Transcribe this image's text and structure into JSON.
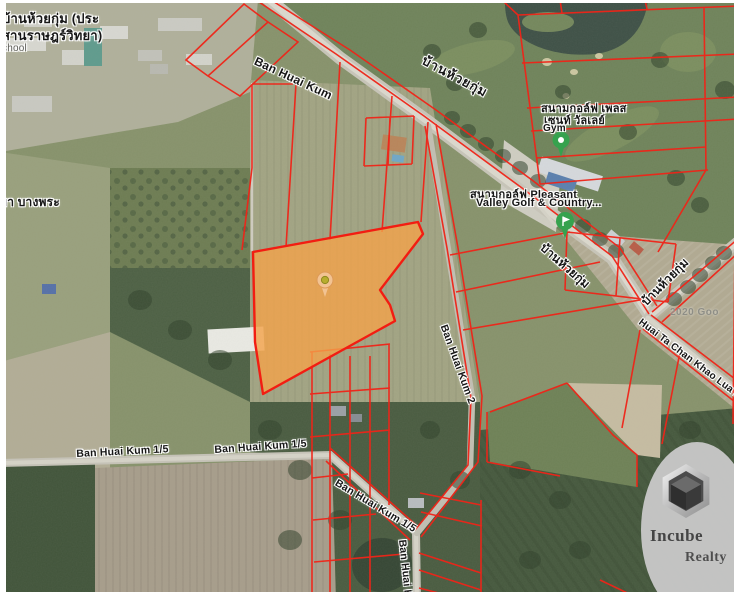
{
  "window": {
    "width": 739,
    "height": 600,
    "view": "satellite-map-with-parcel-overlay"
  },
  "map": {
    "attribution": "2020 Goo",
    "place_labels": {
      "school_line1": "บ้านห้วยกุ่ม (ประ",
      "school_line2": "สานราษฎร์วิทยา)",
      "school_line3": "chool",
      "village_left": "ยา บางพระ",
      "golf_thai_line1": "สนามกอล์ฟ เพลส",
      "golf_thai_line2": "เซนท์ วัลเลย์",
      "gym": "Gym",
      "golf_en_line1": "สนามกอล์ฟ Pleasant",
      "golf_en_line2": "Valley Golf & Country..."
    },
    "road_labels": {
      "ban_huai_kum": "Ban Huai Kum",
      "ban_huai_kum_thai_top": "บ้านห้วยกุ่ม",
      "ban_huai_kum_thai_right": "บ้านห้วยกุ่ม",
      "ban_huai_kum_thai_edge": "บ้านห้วยกุ่ม",
      "huai_ta_chan": "Huai Ta Chan Khao Lua Rd",
      "ban_huai_kum_15_a": "Ban Huai Kum 1/5",
      "ban_huai_kum_15_b": "Ban Huai Kum 1/5",
      "ban_huai_kum_15_c": "Ban Huai Kum 1/5",
      "ban_huai_kum_2_mid": "Ban Huai Kum 2",
      "ban_huai_kum_2_bottom": "Ban Huai Kum 2"
    },
    "overlay": {
      "parcel_line_color": "#f02418",
      "highlight_fill": "#f4a24a",
      "highlight_stroke": "#f21d12",
      "highlight_opacity": "0.8"
    },
    "markers": {
      "gym_marker_color": "#36a24e",
      "golf_marker_color": "#36a24e",
      "property_pin_body": "#f2c392",
      "property_pin_center": "#b7ad2e"
    }
  },
  "watermark": {
    "brand_top": "Incube",
    "brand_bottom": "Realty"
  }
}
